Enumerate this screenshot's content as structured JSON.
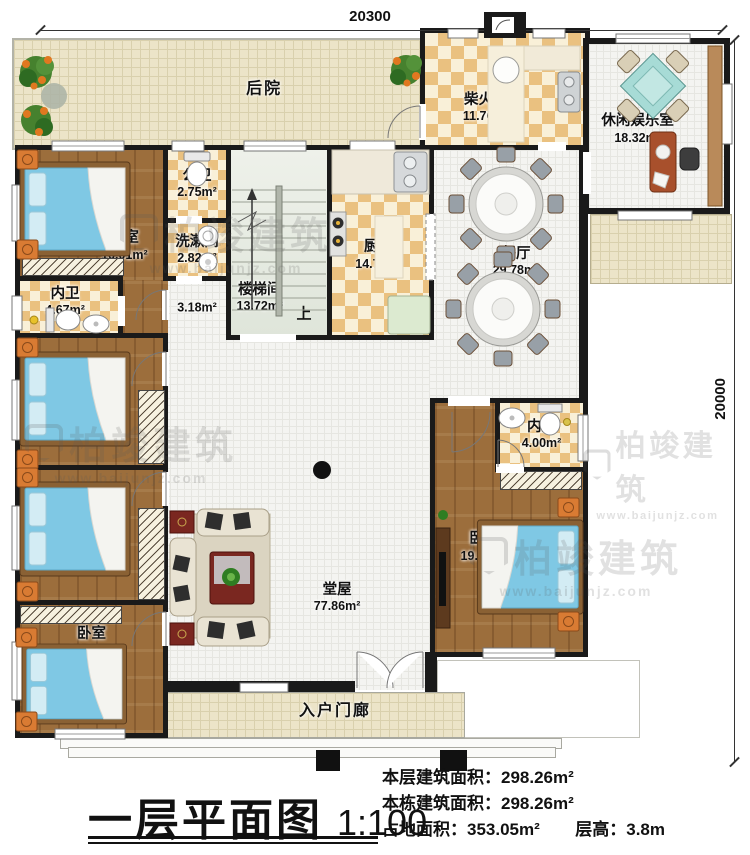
{
  "dimensions": {
    "top": "20300",
    "right": "20000"
  },
  "rooms": {
    "backyard": {
      "label": "后院"
    },
    "firewood": {
      "label": "柴火房",
      "area": "11.76m²"
    },
    "leisure": {
      "label": "休闲娱乐室",
      "area": "18.32m²"
    },
    "bedroom1": {
      "label": "卧室",
      "area": "16.01m²"
    },
    "public_bath": {
      "label": "公卫",
      "area": "2.75m²"
    },
    "washroom": {
      "label": "洗漱间",
      "area": "2.82m²"
    },
    "bath1": {
      "label": "内卫",
      "area": "4.67m²"
    },
    "stairwell": {
      "label": "楼梯间",
      "area": "13.72m²",
      "direction": "上"
    },
    "kitchen": {
      "label": "厨房",
      "area": "14.79m²"
    },
    "dining": {
      "label": "餐厅",
      "area": "29.78m²"
    },
    "corridor": {
      "area": "3.18m²"
    },
    "bedroom2": {
      "label": "卧室",
      "area": "13.31m²"
    },
    "bedroom3": {
      "label": "卧室",
      "area": "14.10m²"
    },
    "bedroom4": {
      "label": "卧室",
      "area": "14.89m²"
    },
    "bath2": {
      "label": "内卫",
      "area": "4.00m²"
    },
    "bedroom5": {
      "label": "卧室",
      "area": "19.57m²"
    },
    "hall": {
      "label": "堂屋",
      "area": "77.86m²"
    },
    "porch": {
      "label": "入户门廊"
    }
  },
  "title_block": {
    "title": "一层平面图",
    "scale": "1:100"
  },
  "info": {
    "floor_area_label": "本层建筑面积：",
    "floor_area": "298.26m²",
    "building_area_label": "本栋建筑面积：",
    "building_area": "298.26m²",
    "land_area_label": "占地面积：",
    "land_area": "353.05m²",
    "height_label": "层高：",
    "height": "3.8m"
  },
  "watermark": {
    "name": "柏竣建筑",
    "url": "www.baijunjz.com"
  }
}
